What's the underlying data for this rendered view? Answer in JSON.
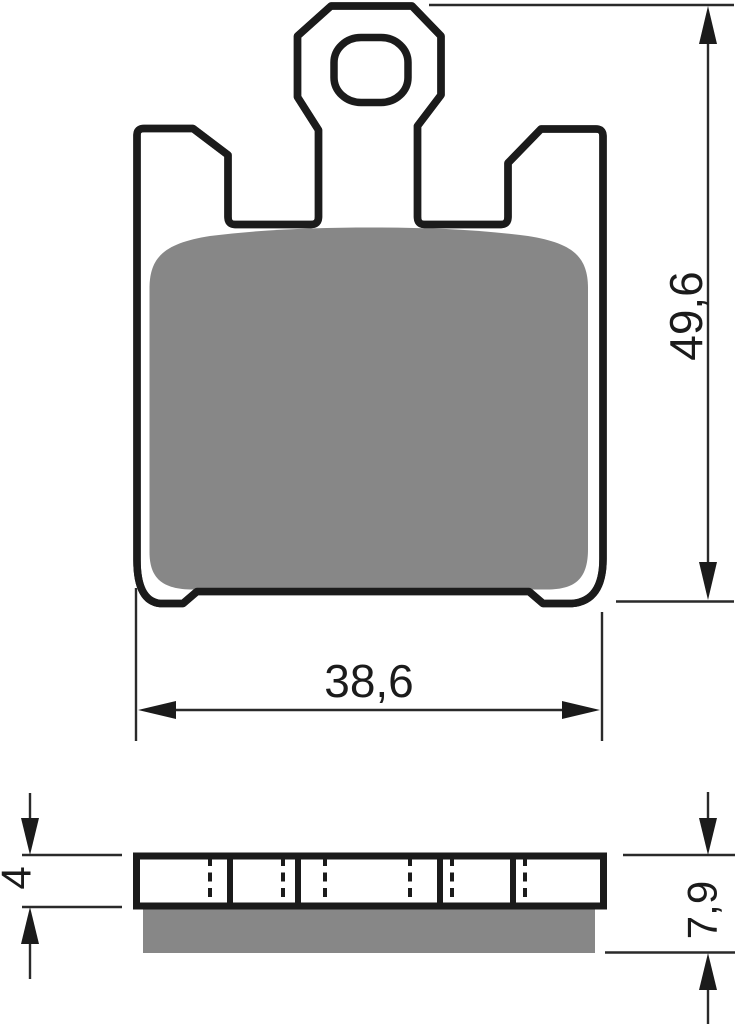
{
  "diagram": {
    "type": "technical-drawing",
    "subject": "brake-pad",
    "colors": {
      "outline": "#1b1b1b",
      "friction_material": "#878787",
      "dimension_lines": "#2a2a2a",
      "background": "#ffffff"
    },
    "front_view": {
      "height_dimension": {
        "label": "49,6",
        "orientation": "vertical"
      },
      "width_dimension": {
        "label": "38,6",
        "orientation": "horizontal"
      }
    },
    "side_view": {
      "plate_thickness_dimension": {
        "label": "4",
        "orientation": "vertical"
      },
      "total_thickness_dimension": {
        "label": "7,9",
        "orientation": "vertical"
      }
    }
  }
}
